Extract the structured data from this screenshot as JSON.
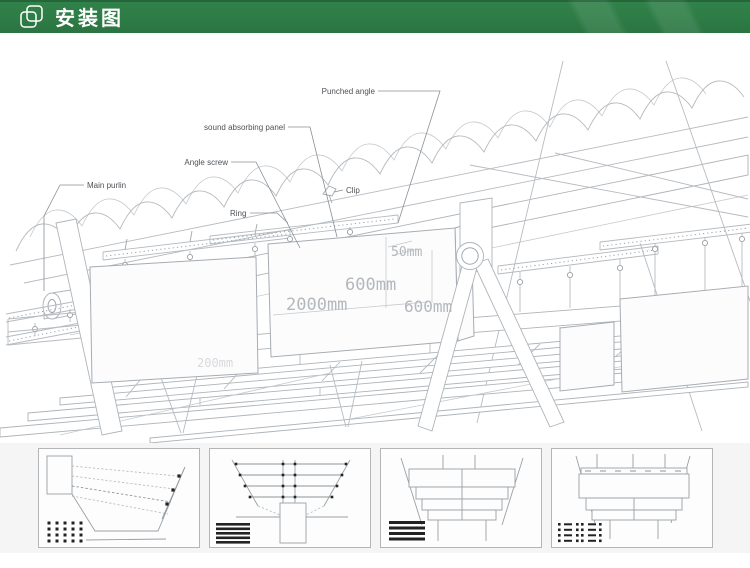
{
  "header": {
    "title": "安装图",
    "accent_color": "#2e7c46",
    "text_color": "#ffffff",
    "icon": "overlap-squares"
  },
  "diagram": {
    "labels": {
      "punched_angle": "Punched angle",
      "sound_absorbing_panel": "sound absorbing panel",
      "angle_screw": "Angle screw",
      "main_purlin": "Main purlin",
      "clip": "Clip",
      "ring": "Ring"
    },
    "dimensions": {
      "panel_thickness": "50mm",
      "panel_height": "600mm",
      "panel_length": "2000mm",
      "panel_spacing": "600mm",
      "grid_spacing": "200mm"
    },
    "line_color": "#b6bbc0",
    "dim_text_color": "#b4b8bb",
    "label_text_color": "#4d5257"
  },
  "thumbnails": {
    "items": [
      {
        "name": "hanging-wires-side-view"
      },
      {
        "name": "suspension-grid-top-view"
      },
      {
        "name": "baffle-stack-front-view"
      },
      {
        "name": "baffle-stack-detail-view"
      }
    ]
  }
}
